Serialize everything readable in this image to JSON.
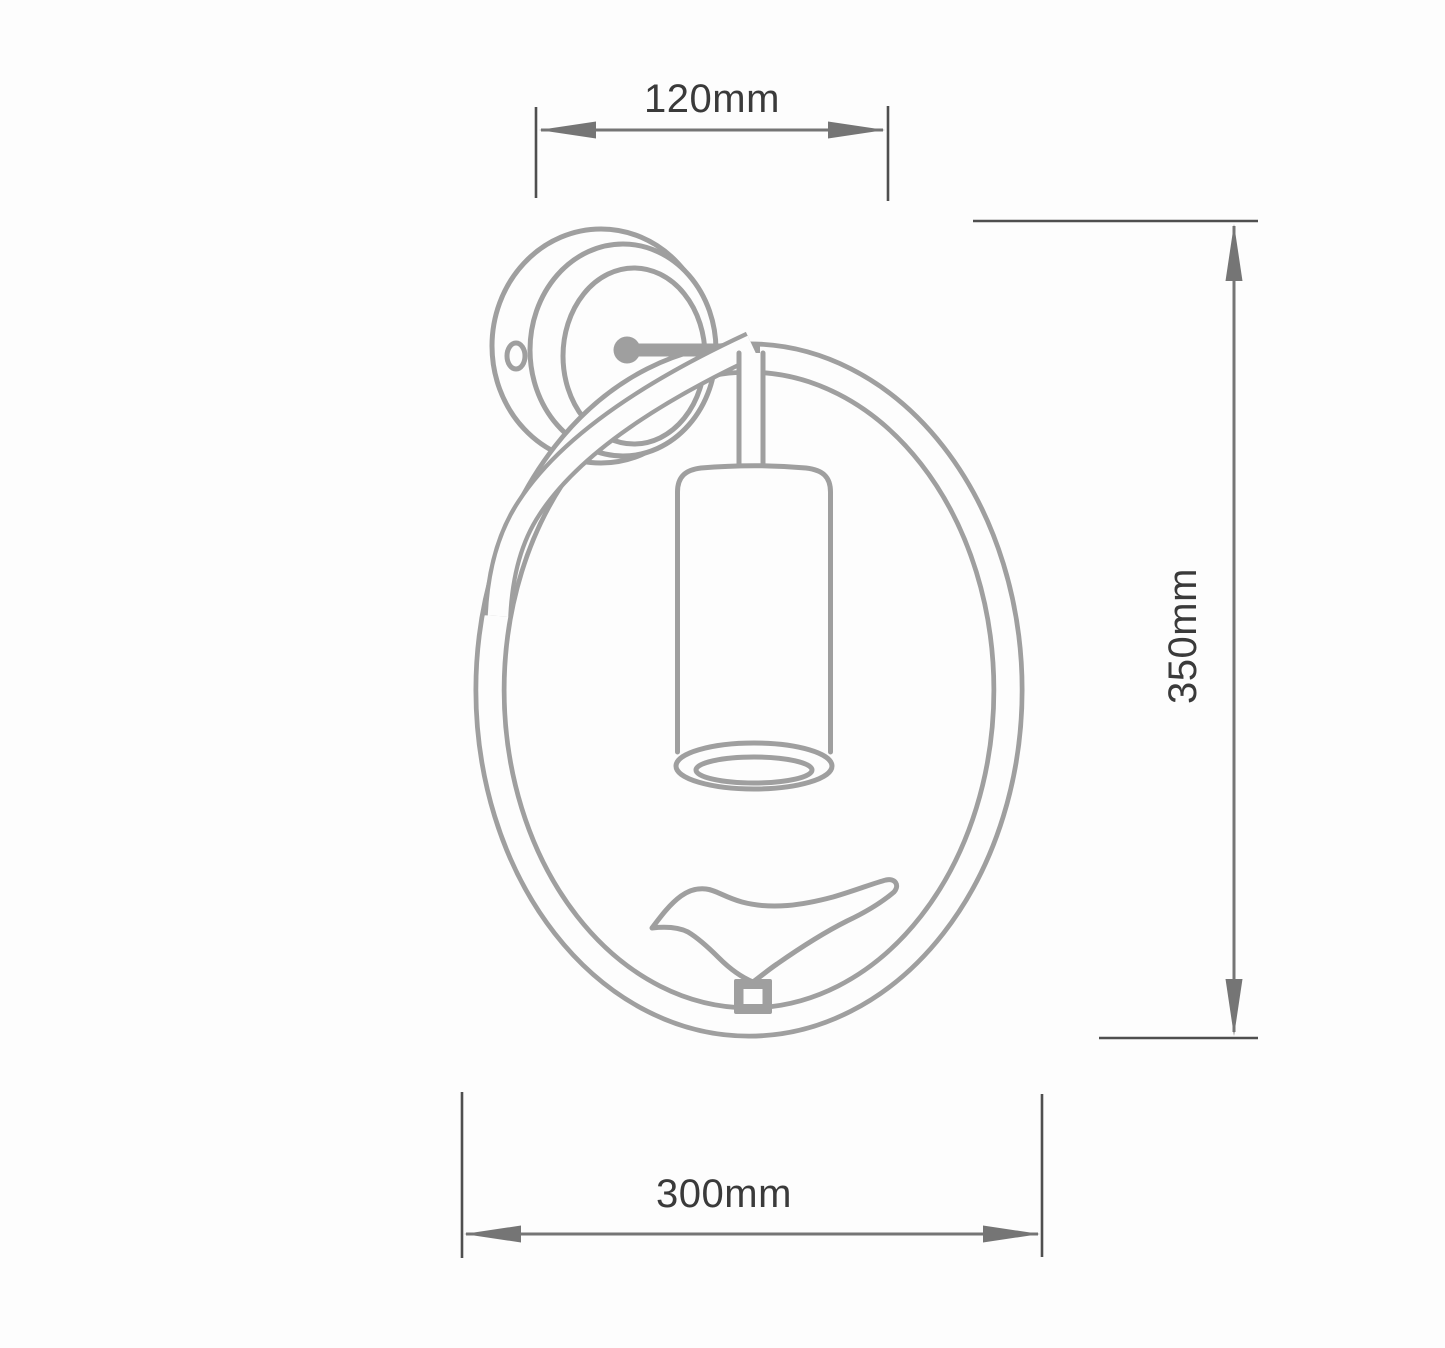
{
  "page": {
    "background": "#fdfdfd"
  },
  "colors": {
    "line": "#9f9f9f",
    "dim-line": "#757575",
    "ext-line": "#4f4f4f",
    "label": "#3a3a3a",
    "bg": "#fdfdfd"
  },
  "dimensions": {
    "top_width": {
      "label": "120mm"
    },
    "right_height": {
      "label": "350mm"
    },
    "bottom_width": {
      "label": "300mm"
    }
  }
}
